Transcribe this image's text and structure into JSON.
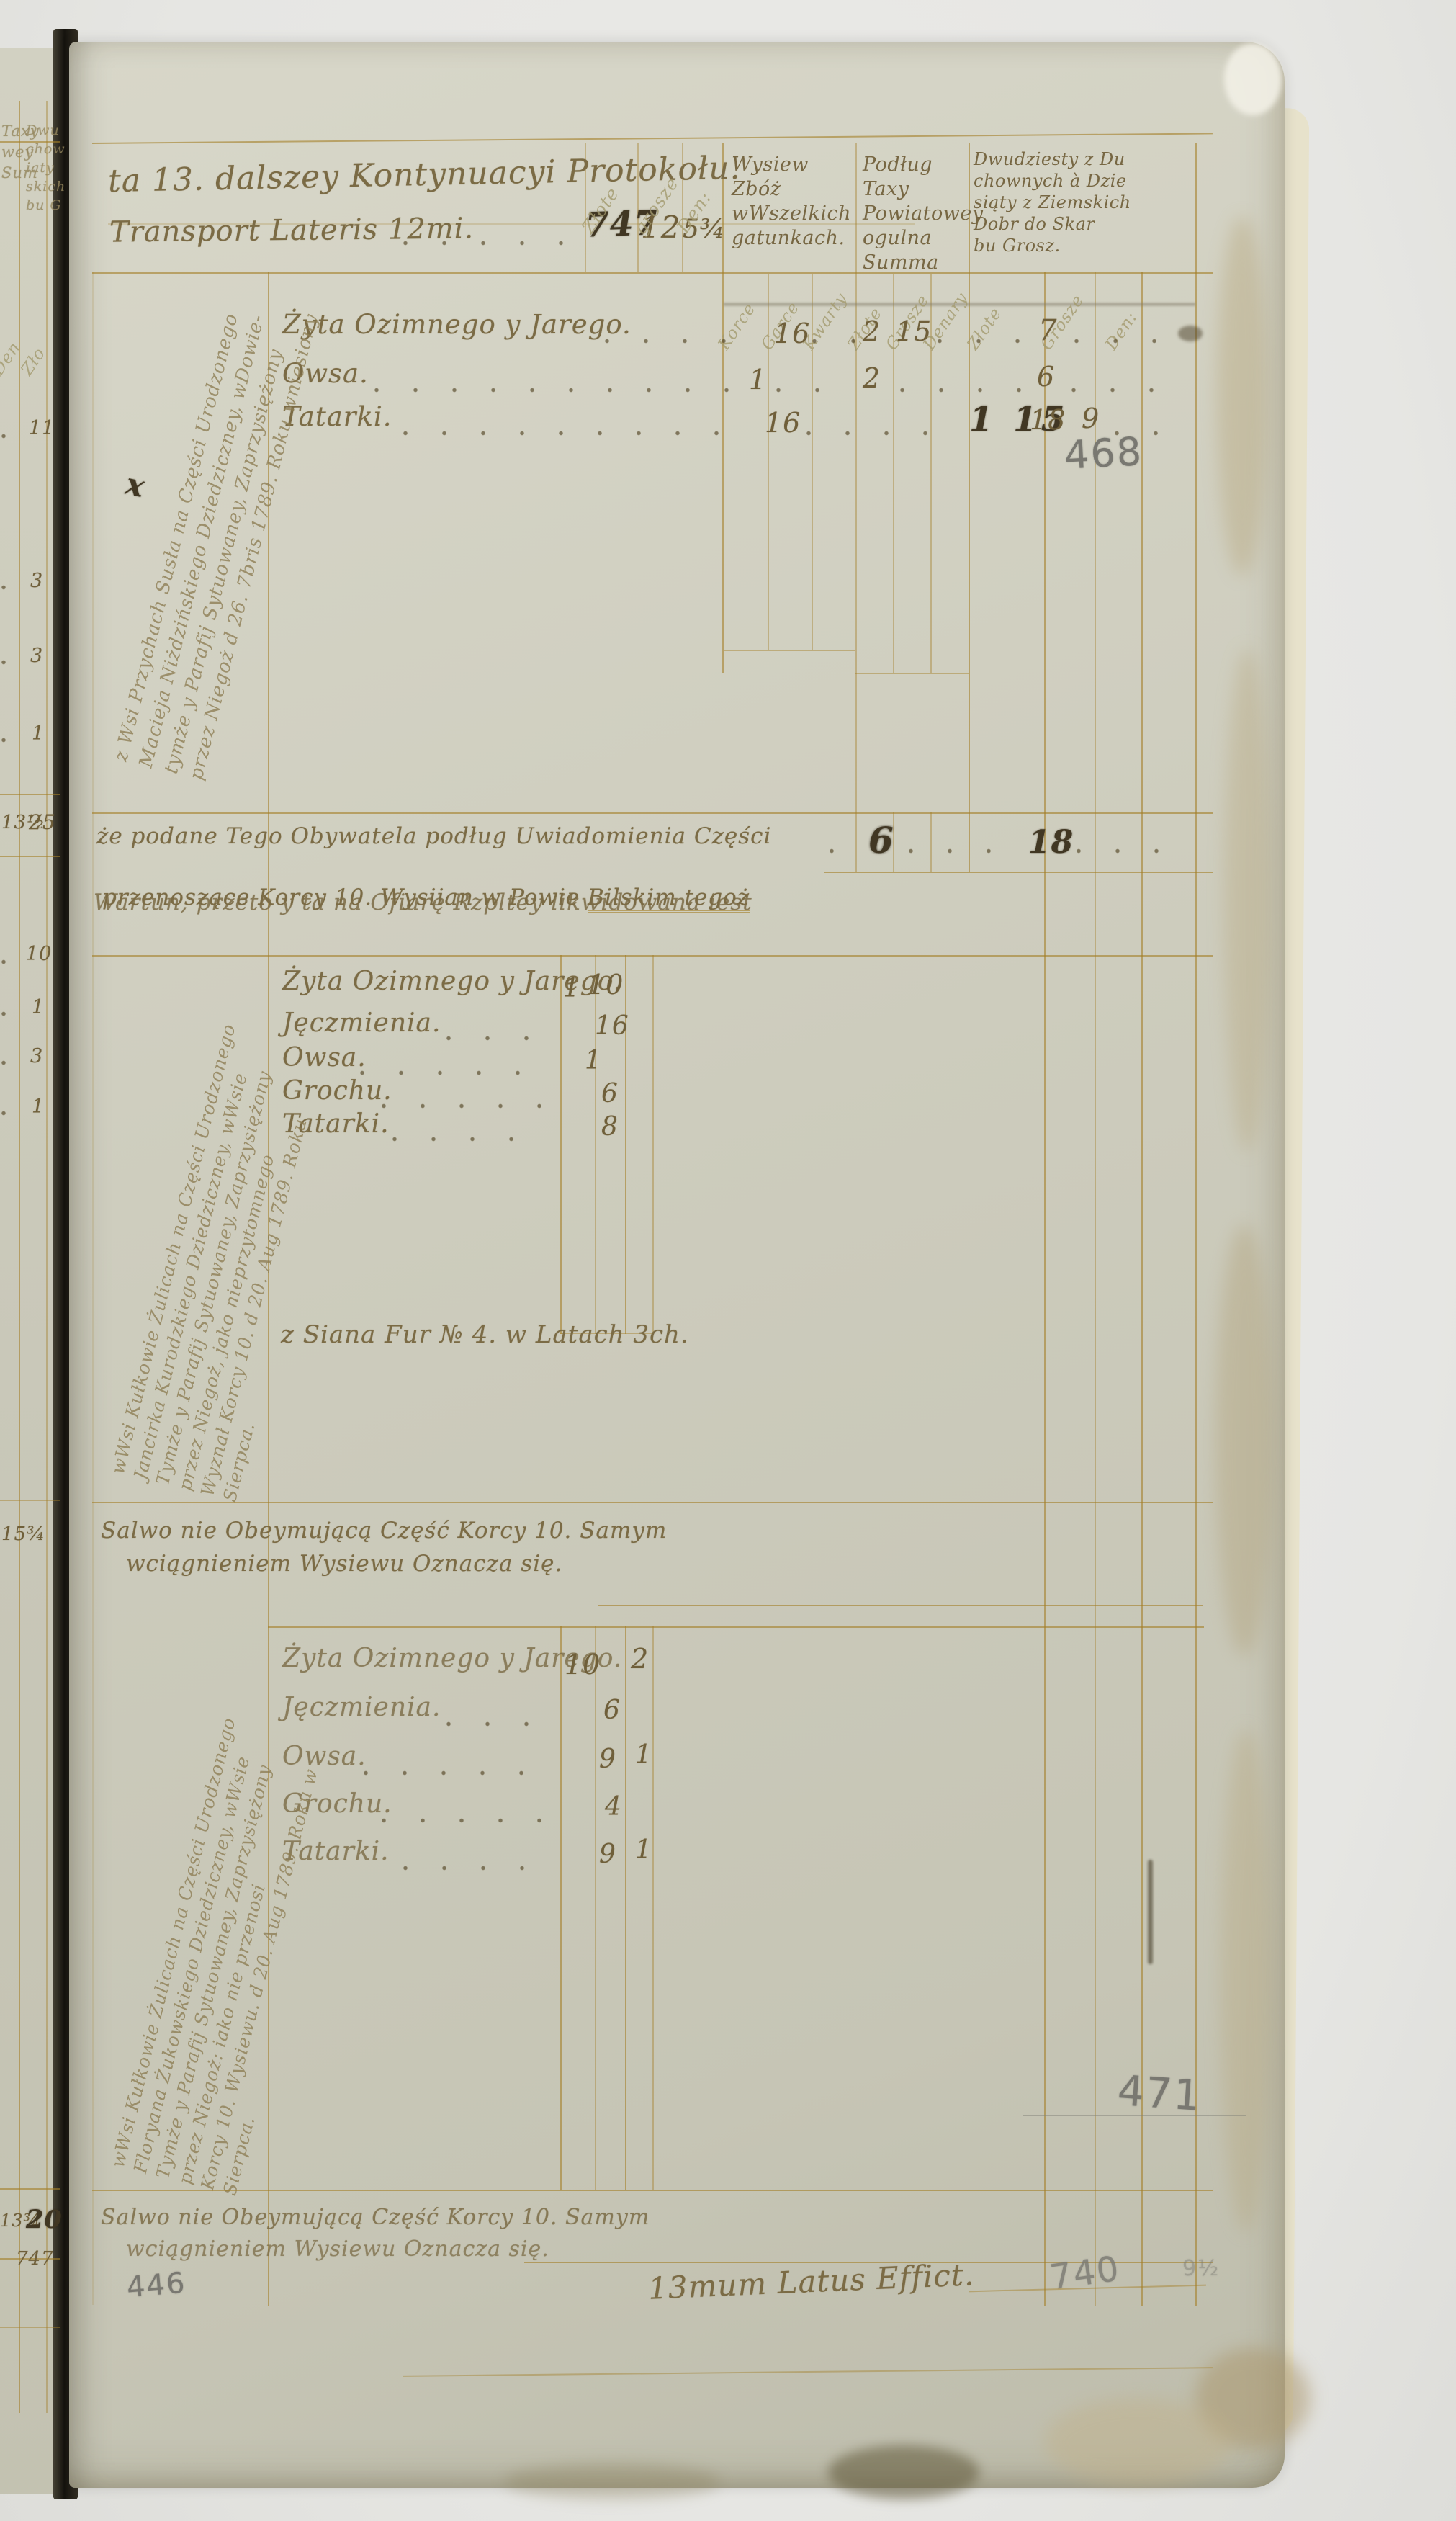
{
  "doc": {
    "header": {
      "title": "ta 13. dalszey Kontynuacyi Protokołu.",
      "transport": "Transport Lateris 12mi.",
      "v_zl": "747",
      "v_gr": "12",
      "v_den": "5¾",
      "cur": [
        "Złote",
        "grosze",
        "Den:"
      ]
    },
    "groups": {
      "g1": "Wysiew Zbóż\nwWszelkich\ngatunkach.",
      "g2": "Podług Taxy\nPowiatowey\nogulna Summa",
      "g3": "Dwudziesty z Du\nchownych à Dzie\nsiąty z Ziemskich\nDobr do Skar\nbu Grosz."
    },
    "subcols": [
      "Korce",
      "Garce",
      "Kwarty",
      "Złote",
      "Grosze",
      "Denary",
      "Złote",
      "Grosze",
      "Den:"
    ],
    "s1": {
      "rows": [
        {
          "label": "Żyta Ozimnego y Jarego.",
          "garce": "16",
          "zl": "2",
          "gr": "15",
          "pod": "7"
        },
        {
          "label": "Owsa.",
          "garce": "1",
          "zl": "2",
          "pod": "6"
        },
        {
          "label": "Tatarki.",
          "garce": "16",
          "corr": "1 15",
          "pod": "18",
          "den": "9"
        }
      ],
      "pencil": "468",
      "margin_mark": "x",
      "margin_note": "z Wsi Przychach Susła na Części Urodzonego\nMacieja Niżdzińskiego Dziedziczney, wDowie-\ntymże y Parafij Sytuowaney, Zaprzysiężony\nprzez Niegoż d 26. 7bris 1789. Roku wniesiony"
    },
    "mid": {
      "l1": "że podane Tego Obywatela podług Uwiadomienia Części",
      "l2a": "przenoszące Korcy 10. Wysiian w Powie ",
      "l2b": "Bilskim tegoż",
      "l3": "Wartun, przeto y ta na Ofiarę Rzpltey likwidowana iest",
      "zl": "6",
      "gr": "18"
    },
    "s2": {
      "rows": [
        {
          "label": "Żyta Ozimnego y Jarego.",
          "a": "1",
          "b": "10"
        },
        {
          "label": "Jęczmienia.",
          "b": "16"
        },
        {
          "label": "Owsa.",
          "b": "1"
        },
        {
          "label": "Grochu.",
          "b": "6"
        },
        {
          "label": "Tatarki.",
          "b": "8"
        }
      ],
      "siana": "z Siana Fur № 4. w Latach 3ch.",
      "margin_note": "wWsi Kułkowie Żulicach na Części Urodzonego\nJancirka Kurodzkiego Dziedziczney, wWsie\nTymże y Parafij Sytuowaney, Zaprzysiężony\nprzez Niegoż, jako nieprzytomnego\nWyznał Korcy 10. d 20. Aug 1789. Roku\nSierpca."
    },
    "salvo": {
      "l1": "Salwo nie Obeymującą Część Korcy 10. Samym",
      "l2": "wciągnieniem Wysiewu Oznacza się."
    },
    "s3": {
      "rows": [
        {
          "label": "Żyta Ozimnego y Jarego.",
          "a": "10",
          "b": "2"
        },
        {
          "label": "Jęczmienia.",
          "a": "6"
        },
        {
          "label": "Owsa.",
          "a": "9",
          "b": "1"
        },
        {
          "label": "Grochu.",
          "a": "4"
        },
        {
          "label": "Tatarki.",
          "a": "9",
          "b": "1"
        }
      ],
      "pencil": "471",
      "margin_note": "wWsi Kułkowie Żulicach na Części Urodzonego\nFloryana Żukowskiego Dziedziczney, wWsie\nTymże y Parafij Sytuowaney, Zaprzysiężony\nprzez Niegoż: iako nie przenosi\nKorcy 10. Wysiewu. d 20. Aug 1789. Roku w\nSierpca."
    },
    "footer": {
      "l1": "Salwo nie Obeymującą Część Korcy 10. Samym",
      "l2": "wciągnieniem Wysiewu Oznacza się.",
      "latus": "13mum Latus Effict.",
      "pencil": "740",
      "faint": "9½",
      "page_pencil": "446"
    },
    "left_page": {
      "h1": "Taxy\nwey\nSum",
      "h2": "Dwu\nchow\niaty\nskich\nbu G",
      "d1": "Den",
      "d2": "Zło",
      "n0": "11",
      "n1": "3",
      "n2": "3",
      "n3": "1",
      "sum1a": "13½",
      "sum1b": "25",
      "m0": "10",
      "m1": "1",
      "m2": "3",
      "m3": "1",
      "sum2": "15¾",
      "sum3a": "13¾",
      "sum3b": "20",
      "sum3c": "747"
    }
  }
}
